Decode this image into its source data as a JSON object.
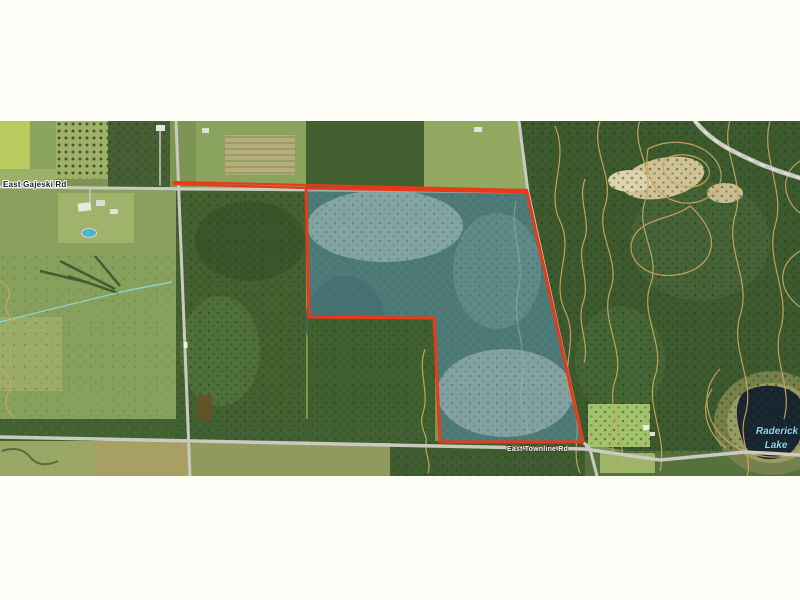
{
  "map": {
    "labels": {
      "road_top": "East Gajeski Rd",
      "road_bottom": "East Townline Rd",
      "lake_line1": "Raderick",
      "lake_line2": "Lake"
    },
    "colors": {
      "page_background": "#fffef8",
      "boundary_red": "#e83a18",
      "wetland_overlay": "#4f8cab",
      "lake_navy": "#18242f",
      "lake_label_blue": "#93d4e6",
      "road_gray": "#c9cbc1",
      "contour_tan": "#c9a55c",
      "road_label_dark": "#141e2a",
      "road_label_light": "#f7f7f0"
    }
  }
}
